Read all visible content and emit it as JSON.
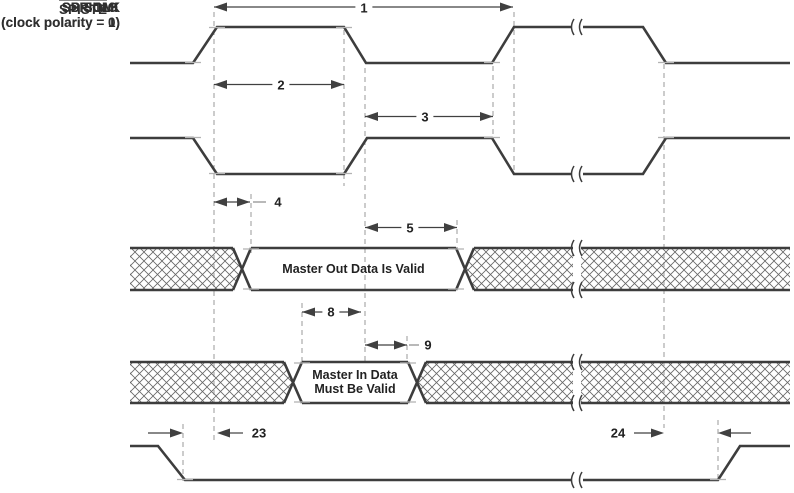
{
  "signals": {
    "spiclk0": {
      "name": "SPICLK",
      "qualifier": "(clock polarity = 0)"
    },
    "spiclk1": {
      "name": "SPICLK",
      "qualifier": "(clock polarity = 1)"
    },
    "spisimo": {
      "name": "SPISIMO",
      "valid_label": "Master Out Data Is Valid"
    },
    "spisomi": {
      "name": "SPISOMI",
      "valid_label_line1": "Master In Data",
      "valid_label_line2": "Must Be Valid"
    },
    "spiste": {
      "name": "SPISTE"
    }
  },
  "annotations": {
    "a1": "1",
    "a2": "2",
    "a3": "3",
    "a4": "4",
    "a5": "5",
    "a8": "8",
    "a9": "9",
    "a23": "23",
    "a24": "24"
  },
  "colors": {
    "waveform_line": "#3d3d3d",
    "dimension_line": "#404040",
    "dashed_guide": "#999999",
    "hatch_line": "#666666",
    "text": "#2f2f2f",
    "background": "#ffffff"
  }
}
